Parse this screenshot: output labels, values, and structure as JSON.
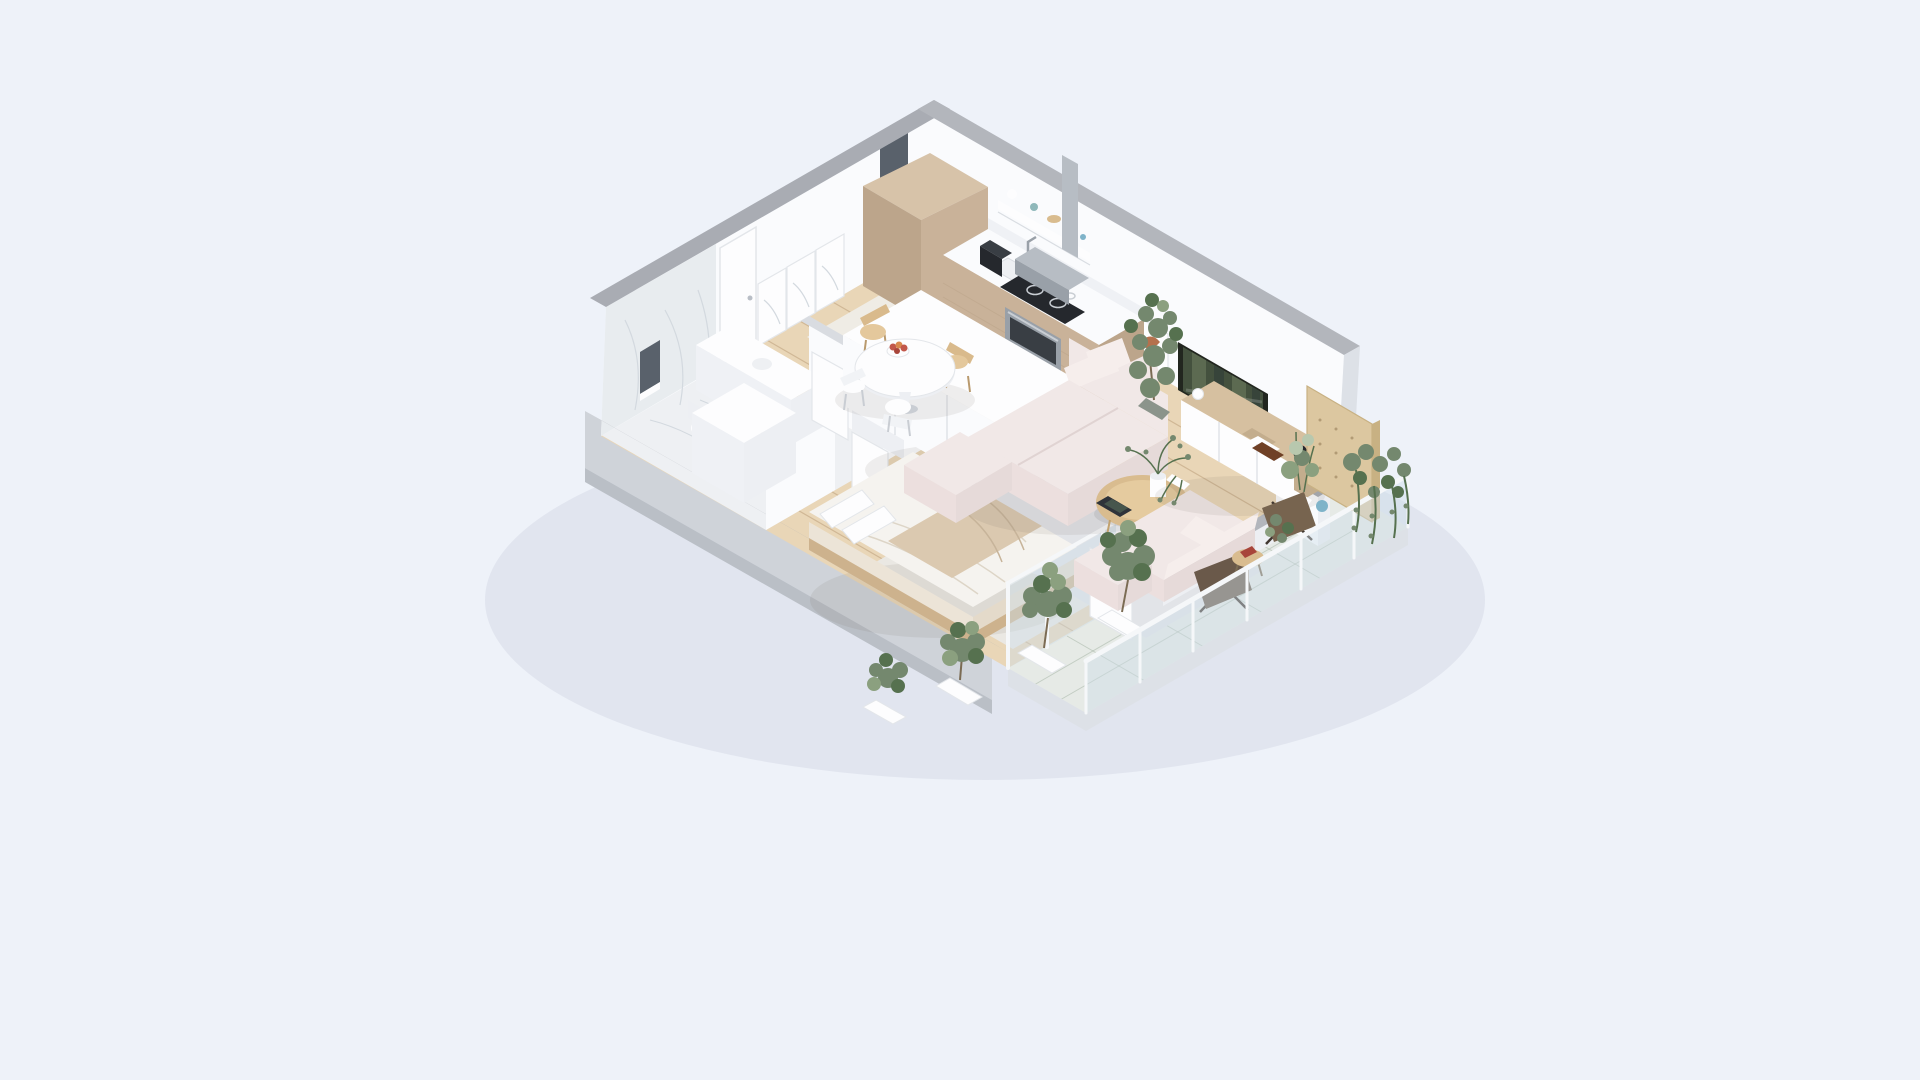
{
  "scene": {
    "kind": "isometric-3d-apartment-floor-plan-render",
    "rooms": {
      "kitchen": {
        "items": [
          "tall-cabinet",
          "counter-with-sink",
          "coffee-maker",
          "induction-cooktop",
          "built-in-oven",
          "extractor-hood-chimney",
          "floating-shelf-with-jars"
        ]
      },
      "dining": {
        "items": [
          "round-white-table",
          "wood-chair",
          "wood-chair",
          "white-chair",
          "white-chair",
          "fruit-bowl",
          "candle"
        ]
      },
      "living": {
        "items": [
          "modular-pink-sofa",
          "back-pillows",
          "ottoman",
          "loveseat",
          "pouf",
          "oval-coffee-table",
          "tablet",
          "flower-vase",
          "media-console",
          "books",
          "black-vase",
          "wall-tv",
          "art-print",
          "fiddle-leaf-plant",
          "gray-area-rug"
        ]
      },
      "bedroom": {
        "items": [
          "double-bed",
          "pillows",
          "beige-throw-blanket",
          "wardrobe",
          "bedroom-rug",
          "sliding-glass-doors",
          "open-door-panel"
        ]
      },
      "bathroom": {
        "items": [
          "marble-wall",
          "marble-floor",
          "vanity-counter",
          "toilet",
          "storage-cube",
          "door-leaf",
          "door-leaf",
          "window-slit"
        ]
      },
      "hallway": {
        "items": [
          "entry-door",
          "framed-print",
          "framed-print",
          "framed-print",
          "window-slit",
          "wood-floor"
        ]
      },
      "balcony": {
        "items": [
          "tile-floor",
          "glass-railing",
          "butterfly-chair",
          "butterfly-chair",
          "side-table",
          "planter-tree",
          "planter-tree",
          "planter-tree",
          "planter-tree",
          "hanging-vines",
          "plywood-privacy-screen",
          "potted-plants",
          "blue-vase"
        ]
      }
    }
  },
  "palette": {
    "bg": "#eef2f9",
    "shadow": "rgba(148,158,182,0.14)",
    "capGray": "#a9acb3",
    "capGrayLight": "#b3b6bc",
    "capLight": "#d9dce1",
    "extWall": "#cfd3d9",
    "extWallBase": "#babfc6",
    "slabEdge": "#dde1e7",
    "wallWhite": "#fafbfd",
    "wallShade": "#eff1f5",
    "marbleWall": "#e8ecef",
    "marbleVein": "#d3d9df",
    "marbleFloor": "#eef0f3",
    "woodFloor": "#e9d6b7",
    "woodLine": "rgba(178,146,108,0.45)",
    "terrazzo": "#efece5",
    "terrazzoDot": "#ccc5b8",
    "rugGray": "#e2e4e8",
    "rugBedroom": "#eae8e3",
    "tileFloor": "#e6eae6",
    "tileLine": "rgba(165,180,165,0.55)",
    "glassTint": "rgba(206,221,233,0.45)",
    "railWhite": "#f5f7f9",
    "white": "#fdfdfe",
    "whiteShade": "#edeff3",
    "edgeLight": "#e3e6ea",
    "cabinetTan": "#c9b299",
    "cabinetTanDark": "#bca58b",
    "cabinetTanTop": "#d7c3a9",
    "counterTop": "#fafbfd",
    "applianceDark": "#25282d",
    "steel": "#b7bdc4",
    "steelDark": "#99a0a8",
    "ovenGlass": "#393e44",
    "burnerRing": "#c9ced4",
    "sofaTop": "#f1e8e7",
    "sofaPillow": "#f6eeec",
    "sofaFront": "#e6dad9",
    "sofaSide": "#ecdfde",
    "sofaSeam": "#e0d3d2",
    "woodWarm": "#d9bc8f",
    "woodWarmLight": "#e5cb9f",
    "woodWarmLeg": "#c2a26f",
    "consoleWood": "#d6c0a0",
    "consoleWoodDark": "#c3ad8d",
    "tvFrame": "#22261f",
    "tvScreen": "#44513e",
    "tvStreakA": "#5c6a51",
    "tvStreakB": "#37443a",
    "artRust": "#b5714d",
    "artBrown": "#6f4026",
    "greenMain": "#74886e",
    "greenDark": "#56714f",
    "greenLight": "#8ba07f",
    "greenPale": "#b8c8ae",
    "potGray": "#8b948b",
    "trunk": "#7b6b53",
    "plywood": "#dcc7a0",
    "plywoodEdge": "#c8b183",
    "plywoodDot": "#b29b75",
    "chairDark": "#6a594a",
    "chairDark2": "#77644f",
    "chairLeg": "#403730",
    "blanketBeige": "#dbc9b0",
    "blanketLine": "#c7b49a",
    "bedFold": "#ddd5c7",
    "bedSideA": "#e4daca",
    "bedSideB": "#ece4d7",
    "bedTop": "#f5f3ef",
    "bedFrame": "#cdb28d",
    "chairWood": "#d9ba8c",
    "chairWoodLight": "#e4c89c",
    "chairWhiteBack": "#f1f3f6",
    "legGray": "#c9cdd3",
    "legWood": "#b99a6e",
    "fruitRed": "#c2574a",
    "fruitDark": "#a8453a",
    "fruitOrange": "#d9894e",
    "teal": "#8fb8ba",
    "blueVase": "#7fb3c9",
    "tabletDark": "#2f333a",
    "tabletScreen": "#47564d",
    "windowDark": "#59616b",
    "seam": "#d9dde2",
    "knob": "#b9bec6",
    "aoShadow": "rgba(110,100,90,0.10)",
    "furnShadow": "rgba(0,0,0,0.07)"
  }
}
